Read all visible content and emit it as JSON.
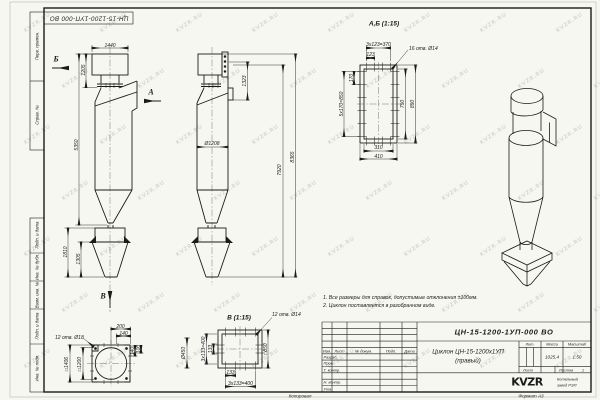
{
  "watermark": {
    "text": "KVZR.RU"
  },
  "stamp": {
    "code": "ЦН-15-1200-1УП-000 ВО"
  },
  "margin": {
    "labels": [
      "Перв. примен.",
      "Справ. №",
      "Подп. и дата",
      "Инв. № дубл.",
      "Взам. инв. №",
      "Подп. и дата",
      "Инв. № подл."
    ]
  },
  "views": {
    "front": {
      "arrow_top": "Б",
      "arrow_right": "А",
      "arrow_bottom": "В",
      "dim_width": "1440",
      "dim_top_height": "1205",
      "dim_body_height": "5350",
      "dim_hopper_height": "1810",
      "dim_hopper_cone": "1305"
    },
    "side": {
      "dim_inlet_height": "1323",
      "dim_diameter": "Ø1208",
      "dim_height_1": "7920",
      "dim_height_2": "8365"
    },
    "detail_ab": {
      "title": "А,Б (1:15)",
      "holes": "16 отв. Ø14",
      "dim_top_total": "3х123=370",
      "dim_top_step": "123",
      "dim_left_step": "170",
      "dim_left_total": "5х170=850",
      "dim_right_inner": "790",
      "dim_right_outer": "890",
      "dim_bottom_inner": "310",
      "dim_bottom_outer": "410"
    },
    "detail_flange": {
      "holes": "12 отв. Ø18",
      "dim_outer_square": "□1406",
      "dim_inner_square": "□1200",
      "dim_top_1": "200",
      "dim_top_2": "140",
      "dim_right_1": "140",
      "dim_right_2": "100"
    },
    "detail_v": {
      "title": "В (1:15)",
      "holes": "12 отв. Ø14",
      "dim_left_total": "3х133=400",
      "dim_left_step": "133",
      "dim_bottom_step": "133",
      "dim_bottom_total": "3х133=400",
      "dim_square": "□850",
      "dim_outlet": "Ø450"
    }
  },
  "notes": {
    "line1": "1. Все размеры для справок, допустимые отклонения ±100мм.",
    "line2": "2. Циклон поставляется в разобранном виде."
  },
  "title_block": {
    "doc_number": "ЦН-15-1200-1УП-000 ВО",
    "name_line1": "Циклон ЦН-15-1200х1УП",
    "name_line2": "(правый)",
    "lit_label": "Лит.",
    "mass_label": "Масса",
    "scale_label": "Масштаб",
    "mass_value": "1025,4",
    "scale_value": "1:50",
    "sheet_label": "Лист",
    "sheets_label": "Листов",
    "sheets_value": "1",
    "col_izm": "Изм.",
    "col_list": "Лист",
    "col_doc": "№ докум.",
    "col_sign": "Подп.",
    "col_date": "Дата",
    "row_razrab": "Разраб.",
    "row_prov": "Пров.",
    "row_tkontr": "Т. контр.",
    "row_nkontr": "Н. контр.",
    "row_utv": "Утв.",
    "logo_text": "KVZR",
    "company_line1": "Котельный",
    "company_line2": "завод РЭП",
    "copied_label": "Копировал",
    "format_label": "Формат А3"
  }
}
